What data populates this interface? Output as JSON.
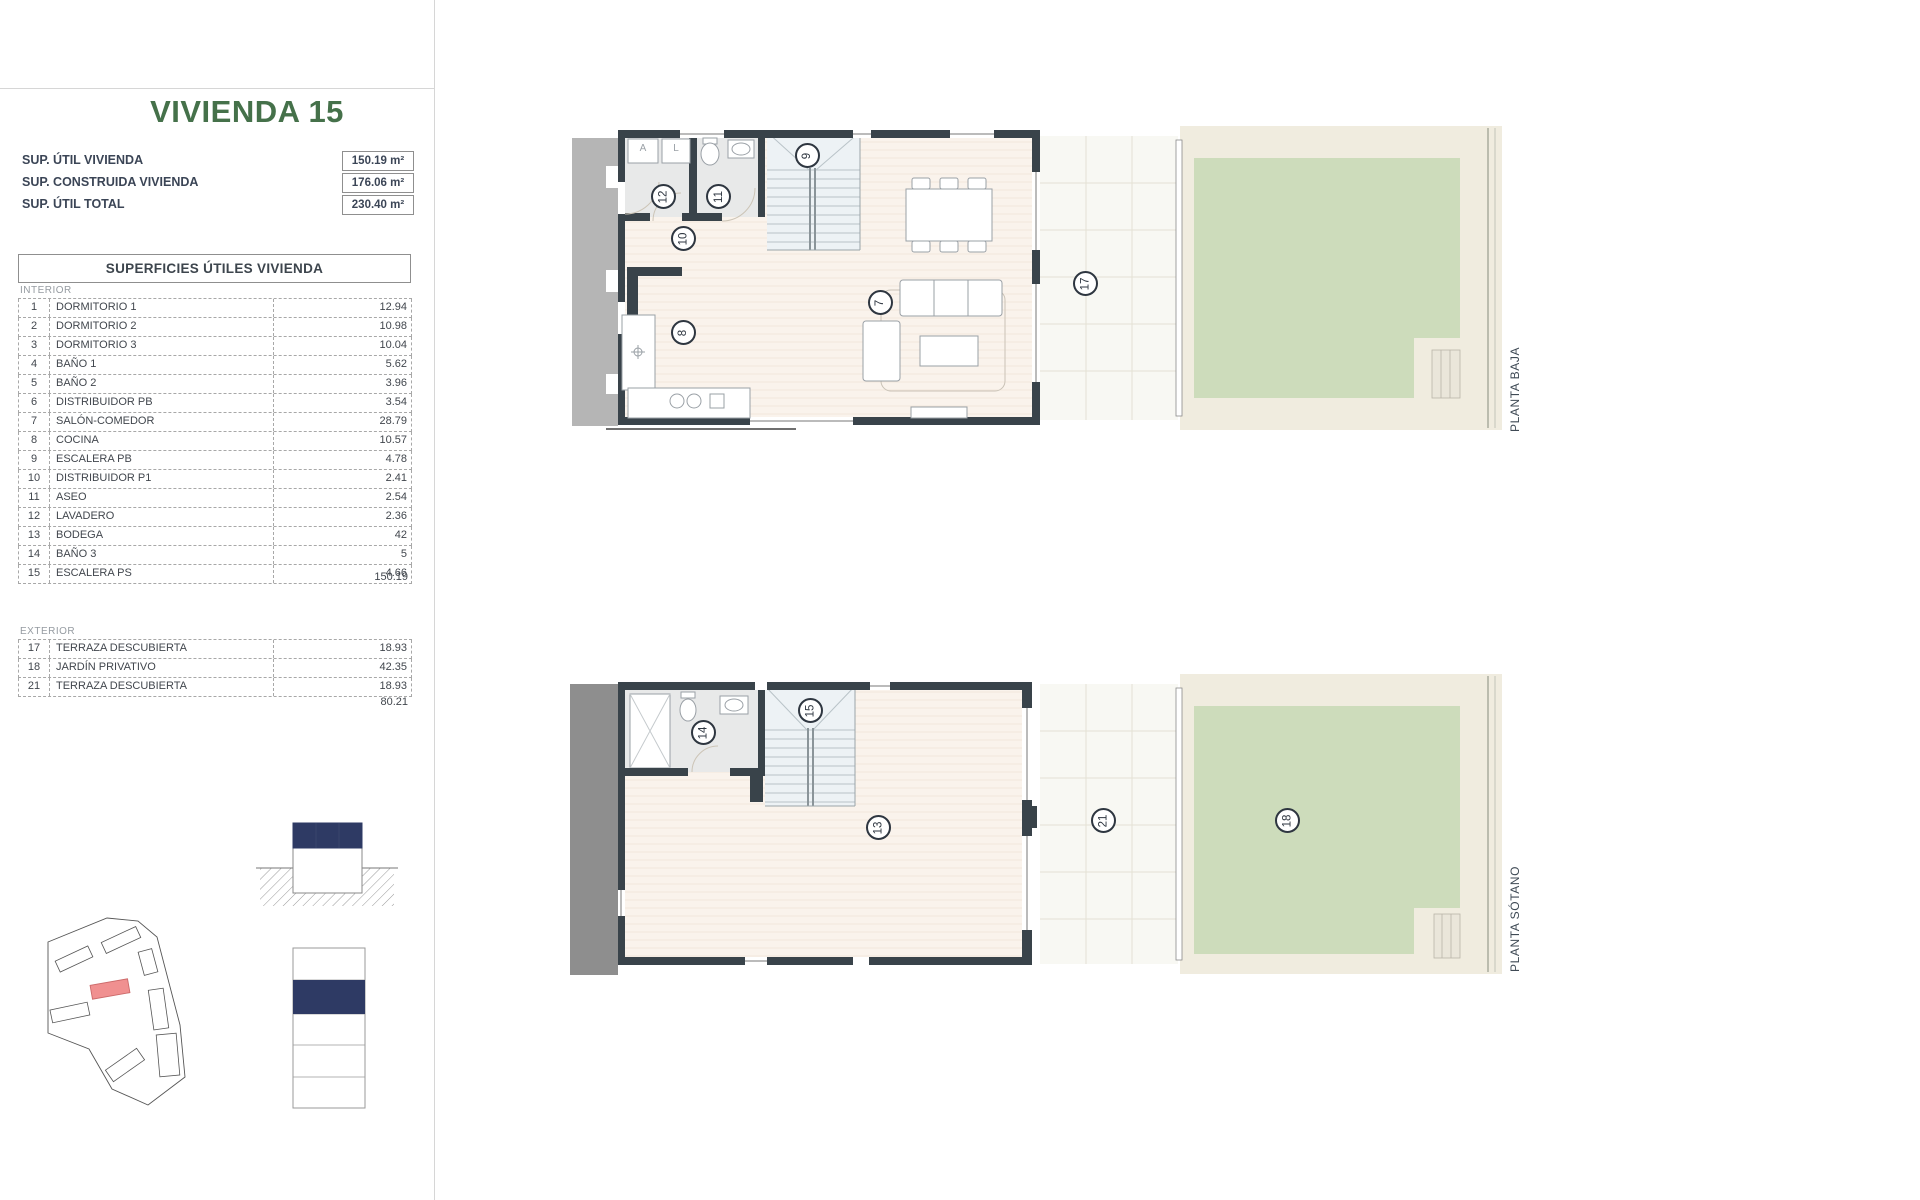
{
  "doc": {
    "title": "VIVIENDA 15",
    "summary": [
      {
        "label": "SUP. ÚTIL VIVIENDA",
        "value": "150.19 m²"
      },
      {
        "label": "SUP. CONSTRUIDA VIVIENDA",
        "value": "176.06 m²"
      },
      {
        "label": "SUP. ÚTIL TOTAL",
        "value": "230.40 m²"
      }
    ],
    "areas": {
      "header": "SUPERFICIES ÚTILES VIVIENDA",
      "interior_label": "INTERIOR",
      "interior_rows": [
        {
          "num": "1",
          "name": "DORMITORIO 1",
          "value": "12.94"
        },
        {
          "num": "2",
          "name": "DORMITORIO 2",
          "value": "10.98"
        },
        {
          "num": "3",
          "name": "DORMITORIO 3",
          "value": "10.04"
        },
        {
          "num": "4",
          "name": "BAÑO 1",
          "value": "5.62"
        },
        {
          "num": "5",
          "name": "BAÑO 2",
          "value": "3.96"
        },
        {
          "num": "6",
          "name": "DISTRIBUIDOR PB",
          "value": "3.54"
        },
        {
          "num": "7",
          "name": "SALÓN-COMEDOR",
          "value": "28.79"
        },
        {
          "num": "8",
          "name": "COCINA",
          "value": "10.57"
        },
        {
          "num": "9",
          "name": "ESCALERA PB",
          "value": "4.78"
        },
        {
          "num": "10",
          "name": "DISTRIBUIDOR P1",
          "value": "2.41"
        },
        {
          "num": "11",
          "name": "ASEO",
          "value": "2.54"
        },
        {
          "num": "12",
          "name": "LAVADERO",
          "value": "2.36"
        },
        {
          "num": "13",
          "name": "BODEGA",
          "value": "42"
        },
        {
          "num": "14",
          "name": "BAÑO 3",
          "value": "5"
        },
        {
          "num": "15",
          "name": "ESCALERA PS",
          "value": "4.66"
        }
      ],
      "interior_total": "150.19",
      "exterior_label": "EXTERIOR",
      "exterior_rows": [
        {
          "num": "17",
          "name": "TERRAZA DESCUBIERTA",
          "value": "18.93"
        },
        {
          "num": "18",
          "name": "JARDÍN PRIVATIVO",
          "value": "42.35"
        },
        {
          "num": "21",
          "name": "TERRAZA DESCUBIERTA",
          "value": "18.93"
        }
      ],
      "exterior_total": "80.21"
    }
  },
  "plans": {
    "baja": {
      "label": "PLANTA BAJA",
      "appliances": [
        "A",
        "L"
      ],
      "markers": [
        "12",
        "11",
        "10",
        "9",
        "8",
        "7",
        "17"
      ]
    },
    "sotano": {
      "label": "PLANTA SÓTANO",
      "markers": [
        "14",
        "15",
        "13",
        "21",
        "18"
      ]
    }
  },
  "colors": {
    "title_green": "#45714a",
    "navy_highlight": "#2e3a64",
    "unit_red": "#f09090",
    "garden_green": "#cddcbb",
    "wall_dark": "#39434a"
  }
}
